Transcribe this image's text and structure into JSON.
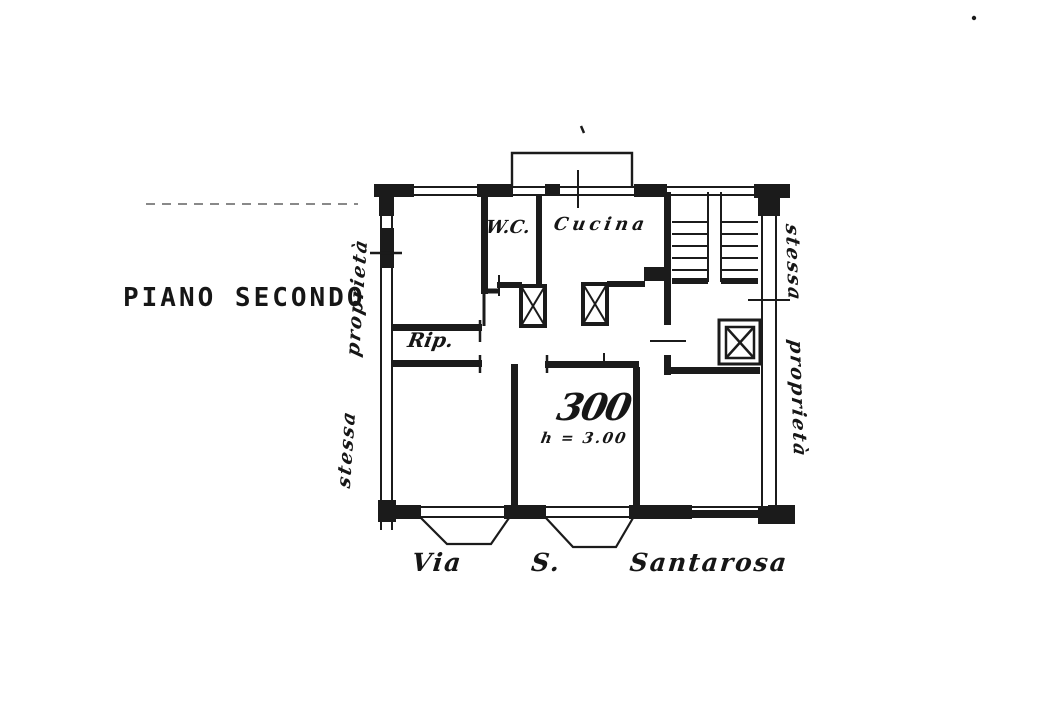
{
  "page": {
    "background": "#ffffff",
    "ink": "#1b1b1b",
    "kind": "scanned cadastral floor plan"
  },
  "plan": {
    "title": "PIANO SECONDO",
    "rooms": {
      "wc": "W.C.",
      "kitchen": "Cucina",
      "storage": "Rip."
    },
    "apartment": {
      "number": "300",
      "height_note": "h = 3.00"
    },
    "street": "Via S. Santarosa",
    "left_boundary": "stessa proprietà",
    "right_boundary": "stessa proprietà"
  }
}
